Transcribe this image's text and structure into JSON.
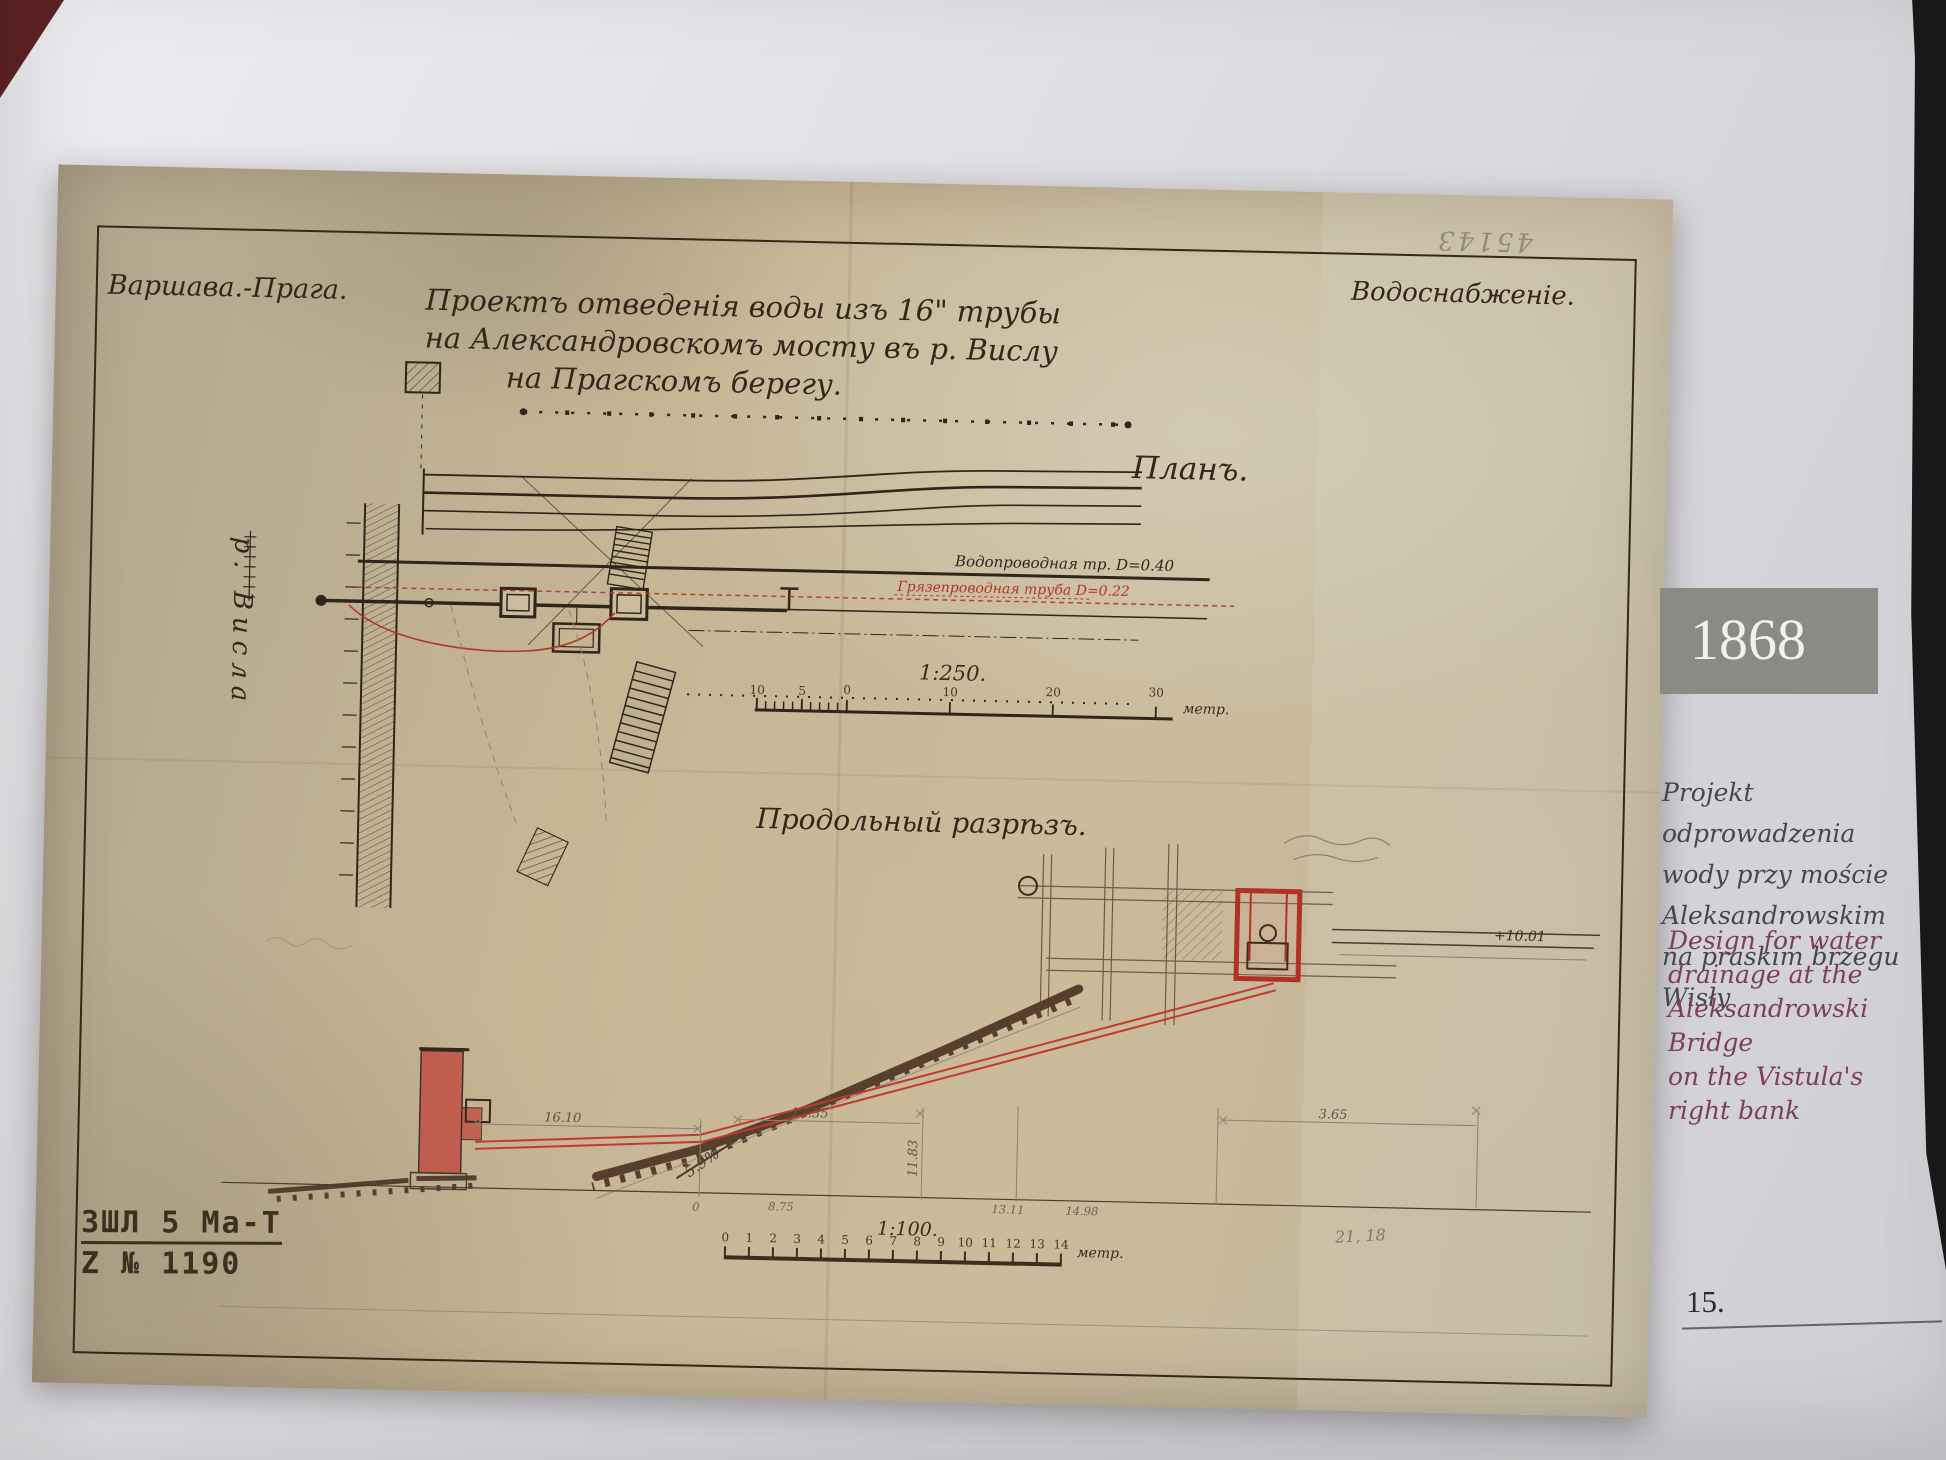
{
  "sidebar": {
    "year": "1868",
    "caption_pl": [
      "Projekt odprowadzenia",
      "wody przy moście",
      "Aleksandrowskim",
      "na praskim brzegu Wisły"
    ],
    "caption_en": [
      "Design for water",
      "drainage at the",
      "Aleksandrowski Bridge",
      "on the Vistula's",
      "right bank"
    ],
    "page_number": "15."
  },
  "drawing": {
    "corner_left": "Варшава.-Прага.",
    "corner_right": "Водоснабженіе.",
    "pencil_top": "45143",
    "title_lines": [
      "Проектъ отведенія воды изъ 16\" трубы",
      "на Александровскомъ мосту въ р. Вислу",
      "на Прагскомъ берегу."
    ],
    "plan_label": "Планъ.",
    "river_label": "р. Висла",
    "pipe_black_label": "Водопроводная тр. D=0.40",
    "pipe_red_label": "Грязепроводная труба D=0.22",
    "plan_scale": {
      "label": "1:250.",
      "ticks": [
        "10",
        "5",
        "0",
        "10",
        "20",
        "30"
      ],
      "unit": "метр."
    },
    "section_label": "Продольный разрѣзъ.",
    "section_scale": {
      "label": "1:100.",
      "ticks": [
        "0",
        "1",
        "2",
        "3",
        "4",
        "5",
        "6",
        "7",
        "8",
        "9",
        "10",
        "11",
        "12",
        "13",
        "14"
      ],
      "unit": "метр."
    },
    "section_values": {
      "level": "+10.01",
      "d1": "16.10",
      "d2": "17.35",
      "d3": "3.65",
      "v1": "11.83",
      "slope": "5.9%",
      "b0": "0",
      "b1": "8.75",
      "b2": "13.11",
      "b3": "14.98",
      "pencil_note": "21, 18"
    },
    "stamp_line1": "ЗШЛ 5 Ма-Т",
    "stamp_line2": "Z № 1190"
  }
}
